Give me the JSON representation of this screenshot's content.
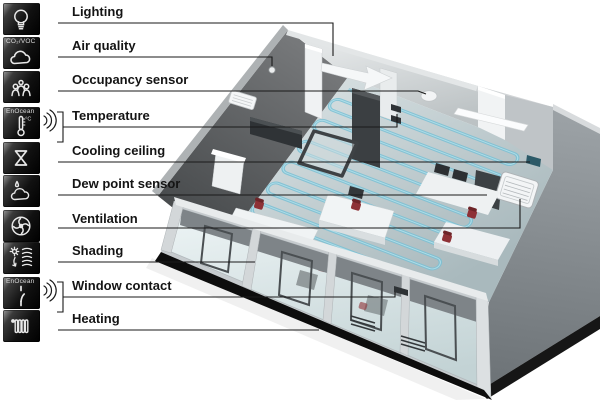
{
  "figure": {
    "description": "Room automation functions diagram with 3D office cutaway",
    "legend": {
      "items": [
        {
          "label": "Lighting",
          "icon": "lightbulb-icon"
        },
        {
          "label": "Air quality",
          "icon": "air-quality-cloud-icon",
          "caption": "CO₂/VOC"
        },
        {
          "label": "Occupancy sensor",
          "icon": "occupancy-people-icon"
        },
        {
          "label": "Temperature",
          "icon": "thermometer-icon",
          "caption": "EnOcean",
          "unit": "°C",
          "wireless": true
        },
        {
          "label": "Cooling ceiling",
          "icon": "cooling-hourglass-icon"
        },
        {
          "label": "Dew point sensor",
          "icon": "dew-point-droplet-cloud-icon"
        },
        {
          "label": "Ventilation",
          "icon": "fan-icon"
        },
        {
          "label": "Shading",
          "icon": "sun-blinds-icon"
        },
        {
          "label": "Window contact",
          "icon": "window-contact-switch-icon",
          "caption": "EnOcean",
          "wireless": true
        },
        {
          "label": "Heating",
          "icon": "radiator-icon"
        }
      ]
    },
    "colors": {
      "coil": "#79c0d4",
      "coil_highlight": "#b9e4ee",
      "chair_red": "#8e3136",
      "wall_dark": "#55585a",
      "glass": "#dfe9ea",
      "base_black": "#0d0d0d",
      "line_black": "#1a1a1a"
    }
  }
}
